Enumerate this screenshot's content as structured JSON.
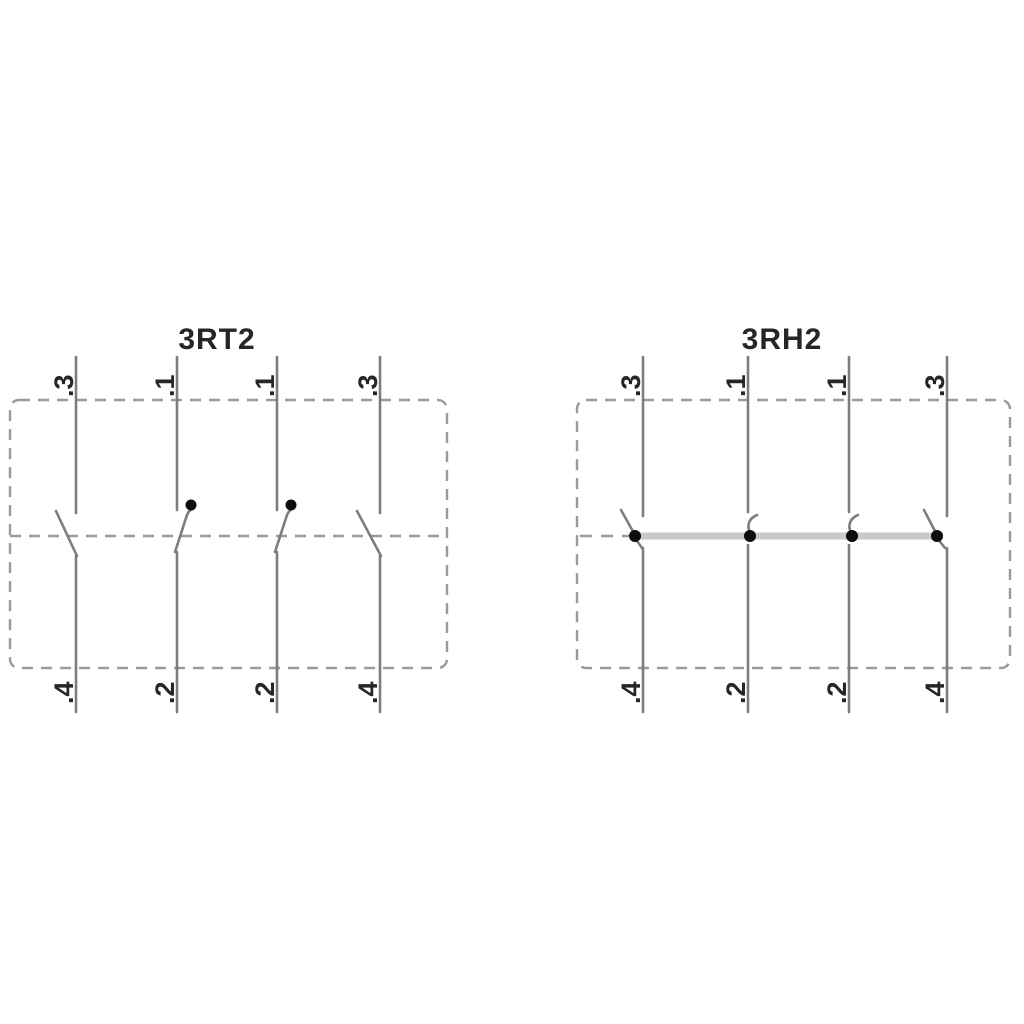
{
  "colors": {
    "line": "#7d7d7d",
    "dash": "#9a9a9a",
    "bar": "#c9c9c9",
    "dot": "#0d0d0d",
    "text": "#262626"
  },
  "diagrams": [
    {
      "title": "3RT2",
      "top_labels": [
        ".3",
        ".1",
        ".1",
        ".3"
      ],
      "bottom_labels": [
        ".4",
        ".2",
        ".2",
        ".4"
      ]
    },
    {
      "title": "3RH2",
      "top_labels": [
        ".3",
        ".1",
        ".1",
        ".3"
      ],
      "bottom_labels": [
        ".4",
        ".2",
        ".2",
        ".4"
      ]
    }
  ]
}
